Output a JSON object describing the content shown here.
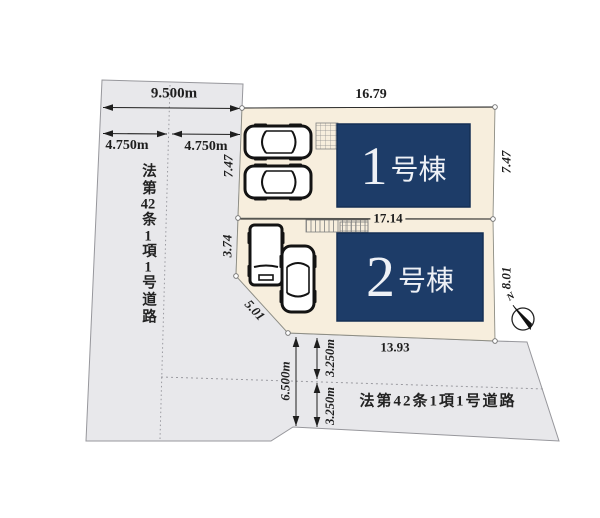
{
  "roads": {
    "left": {
      "name": "法第42条1項1号道路",
      "total_width": "9.500m",
      "half_width_1": "4.750m",
      "half_width_2": "4.750m"
    },
    "bottom": {
      "name": "法第42条1項1号道路",
      "total_width": "6.500m",
      "half_width_1": "3.250m",
      "half_width_2": "3.250m",
      "frontage": "13.93"
    }
  },
  "lots": {
    "lot1": {
      "building_number": "1",
      "building_suffix": "号棟",
      "dim_top": "16.79",
      "dim_right": "7.47",
      "dim_left": "7.47",
      "dim_bottom": "17.14"
    },
    "lot2": {
      "building_number": "2",
      "building_suffix": "号棟",
      "dim_left": "3.74",
      "dim_diagonal": "5.01",
      "dim_right": "8.01",
      "dim_bottom": "13.93"
    }
  },
  "compass": {
    "label": "N"
  },
  "colors": {
    "lot_fill": "#f7eedd",
    "road_fill": "#e8e8eb",
    "building_fill": "#1d3c68",
    "line_color": "#8d8d90",
    "text_color": "#1e1e1e"
  }
}
